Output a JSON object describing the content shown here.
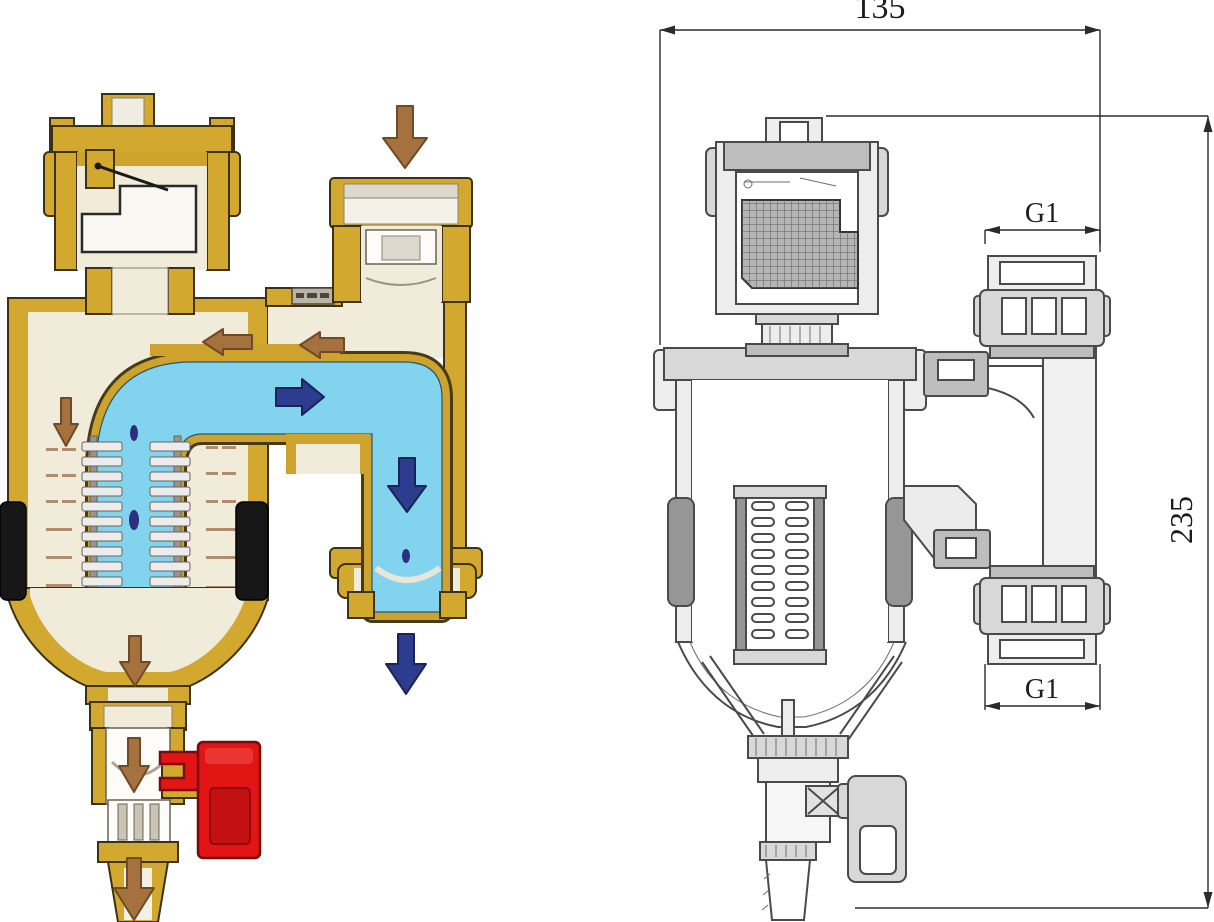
{
  "illustration": {
    "type": "technical-diagram",
    "subject": "magnetic dirt separator filter: colored flow cutaway (left) and dimensioned engineering section (right)"
  },
  "cutaway": {
    "colors": {
      "brass": "#d2a92e",
      "brass_shade": "#b3891f",
      "interior": "#f1ebda",
      "water": "#82d4ee",
      "inlet_arrow_brown": "#a5713e",
      "flow_arrow_blue": "#2c3d8f",
      "magnet_black": "#171717",
      "drain_handle_red": "#e21414",
      "droplet": "#2c2f7e"
    },
    "arrows": [
      {
        "id": "inlet-flow",
        "direction": "down",
        "color": "#a5713e"
      },
      {
        "id": "air-toward-vent-outer",
        "direction": "left",
        "color": "#a5713e"
      },
      {
        "id": "air-toward-vent-inner",
        "direction": "left",
        "color": "#a5713e"
      },
      {
        "id": "air-release",
        "direction": "down",
        "color": "#a5713e"
      },
      {
        "id": "main-flow",
        "direction": "right",
        "color": "#2c3d8f"
      },
      {
        "id": "outlet-downflow",
        "direction": "down",
        "color": "#2c3d8f"
      },
      {
        "id": "outlet-exit",
        "direction": "down",
        "color": "#2c3d8f"
      },
      {
        "id": "sediment-settling",
        "direction": "down",
        "color": "#a5713e"
      },
      {
        "id": "drain-flow",
        "direction": "down",
        "color": "#a5713e"
      },
      {
        "id": "drain-exit",
        "direction": "down",
        "color": "#a5713e"
      }
    ]
  },
  "drawing": {
    "line_color": "#4a4a4a",
    "dimensions": {
      "overall_width": "135",
      "overall_height": "235",
      "top_port_thread": "G1",
      "bottom_port_thread": "G1"
    }
  }
}
